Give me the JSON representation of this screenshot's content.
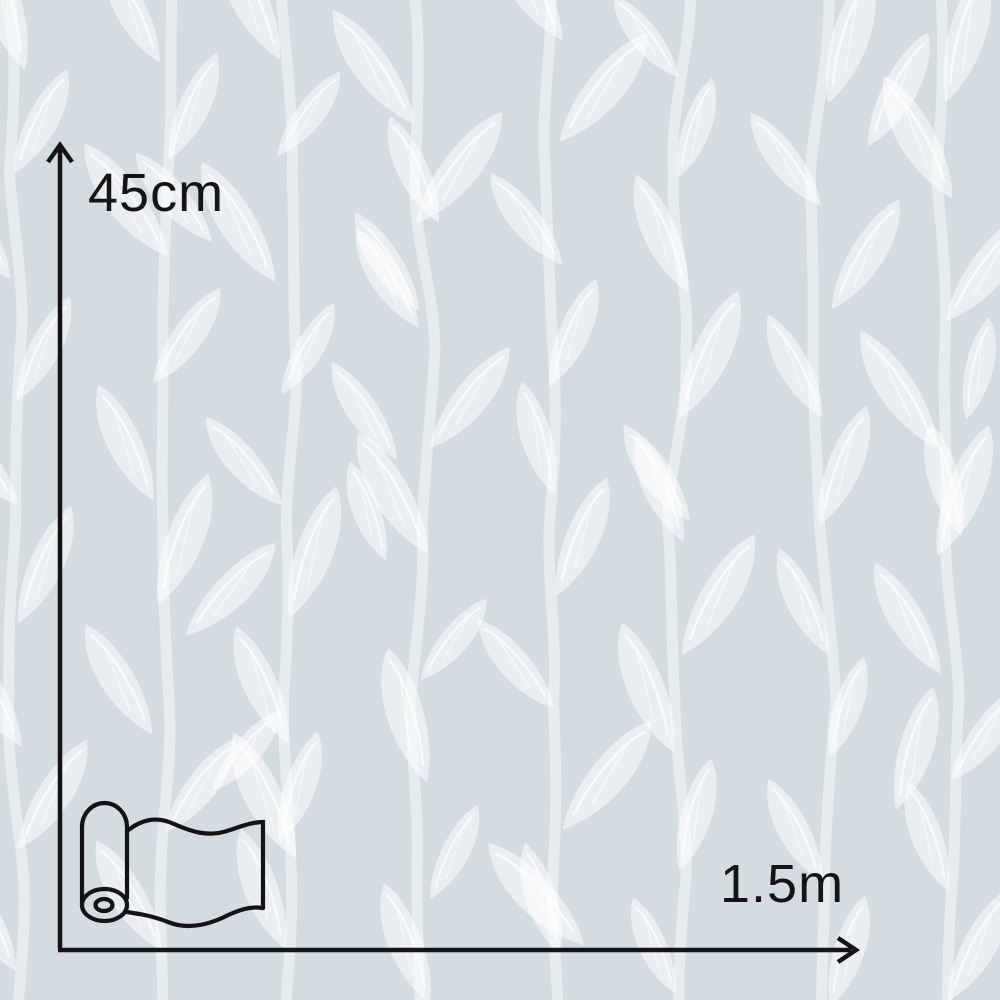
{
  "meta": {
    "description": "Dimension diagram of a patterned wallpaper/window-film roll swatch"
  },
  "swatch": {
    "pattern_name": "white-leaf-branches",
    "colors": {
      "background": "#d3dce1",
      "leaf_fill": "rgba(255,255,255,0.52)",
      "stem_stroke": "rgba(255,255,255,0.45)",
      "vein_stroke": "rgba(255,255,255,0.65)"
    }
  },
  "annotations": {
    "height_label": "45cm",
    "width_label": "1.5m",
    "line_color": "#141414",
    "icons": {
      "roll": "wallpaper-roll-icon",
      "vertical": "up-arrow-icon",
      "horizontal": "right-arrow-icon"
    }
  }
}
